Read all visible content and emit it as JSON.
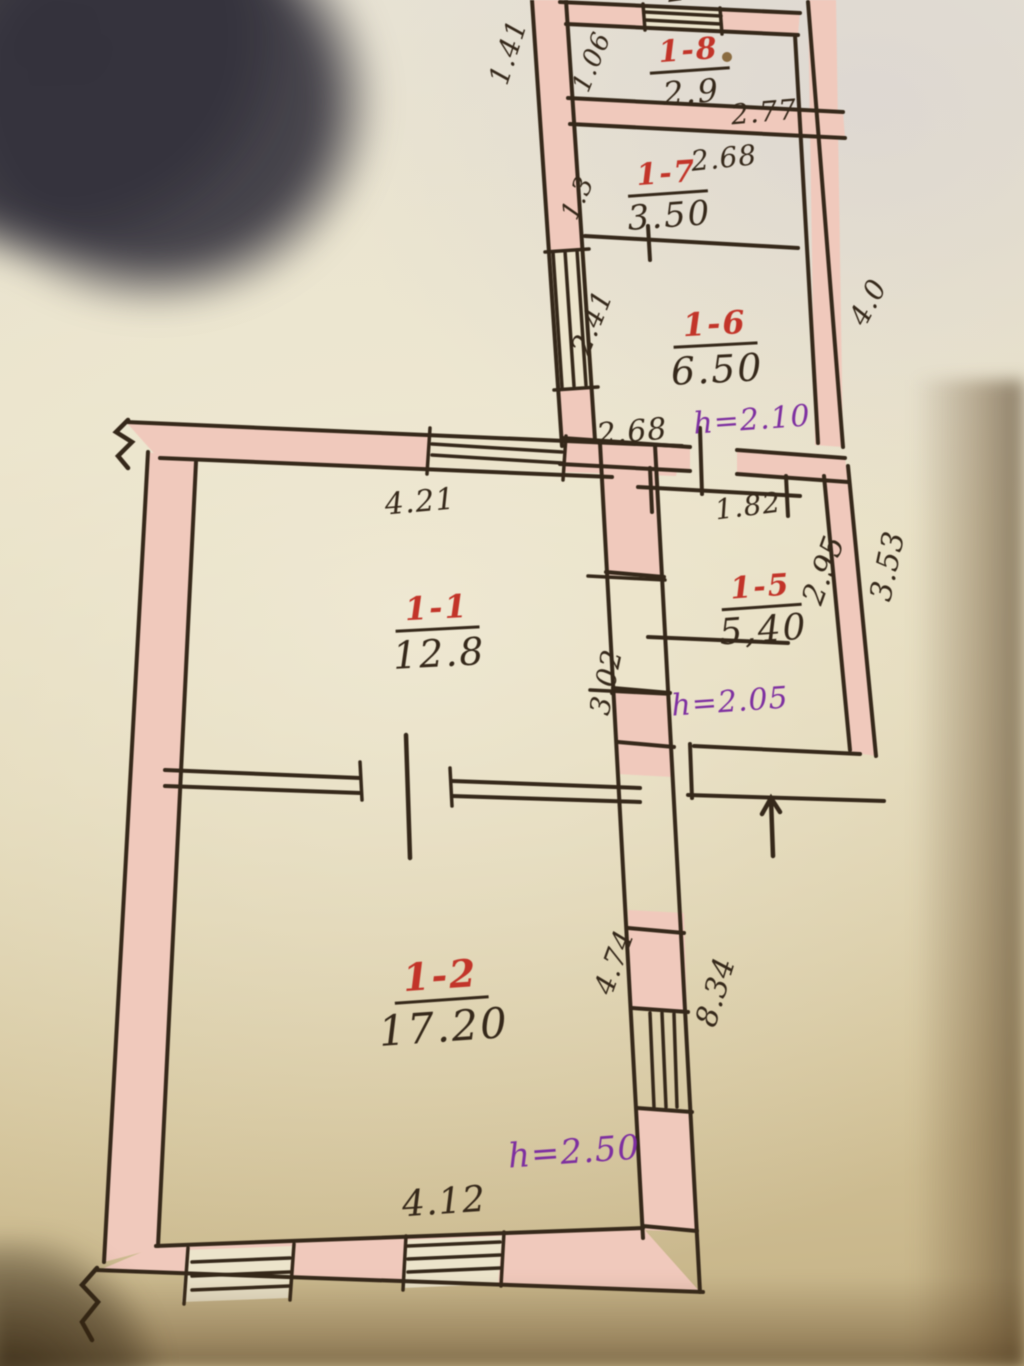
{
  "plan": {
    "title": "hand-drawn apartment floor plan",
    "rooms": {
      "r18": {
        "number": "1-8",
        "area": "2.9"
      },
      "r17": {
        "number": "1-7",
        "area": "3.50"
      },
      "r16": {
        "number": "1-6",
        "area": "6.50",
        "height": "h=2.10"
      },
      "r15": {
        "number": "1-5",
        "area": "5,40",
        "height": "h=2.05"
      },
      "r11": {
        "number": "1-1",
        "area": "12.8"
      },
      "r12": {
        "number": "1-2",
        "area": "17.20",
        "height": "h=2.50"
      }
    },
    "dimensions": {
      "d141": "1.41",
      "d106": "1.06",
      "d277": "2.77",
      "d277_top": "2.77",
      "d268_a": "2.68",
      "d13": "1.3",
      "d241": "2.41",
      "d40": "4.0",
      "d268_b": "2.68",
      "d182": "1.82",
      "d295": "2.95",
      "d353": "3.53",
      "d421": "4.21",
      "d302": "3.02",
      "d474": "4.74",
      "d834": "8.34",
      "d412": "4.12"
    },
    "colors": {
      "ink": "#35281a",
      "room_red": "#c23429",
      "height_purple": "#7d2fa0",
      "wall_pink": "#f0c9bc"
    }
  }
}
